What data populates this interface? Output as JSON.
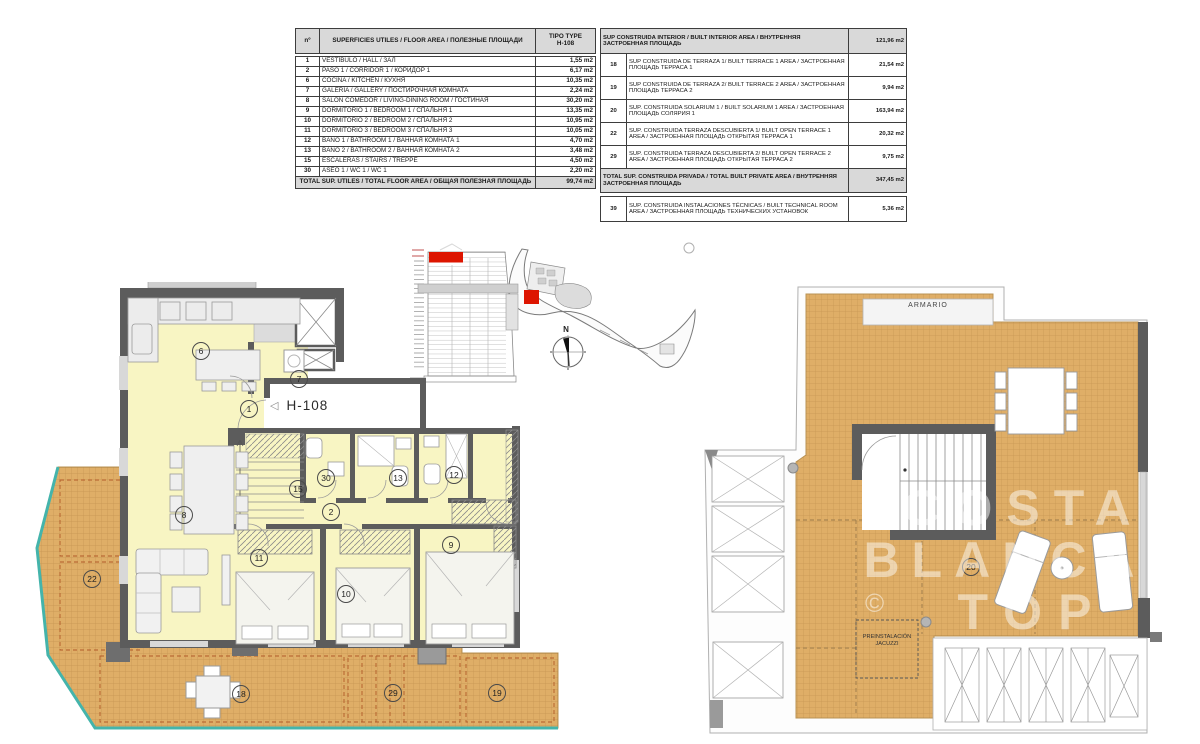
{
  "colors": {
    "terrace_tan": "#dfae67",
    "interior_yellow": "#f8f5c3",
    "wall_gray": "#5c5c5c",
    "teal_edge": "#44b4ab",
    "highlight_red": "#dd1500",
    "table_header_gray": "#d9d9d9"
  },
  "unit": {
    "label": "H-108",
    "pointer": "◁"
  },
  "tables": {
    "floor_area": {
      "col_num": "nº",
      "col_desc": "SUPERFICIES UTILES / FLOOR AREA / ПОЛЕЗНЫЕ ПЛОЩАДИ",
      "col_type_line1": "TIPO TYPE",
      "col_type_line2": "H-108",
      "rows": [
        {
          "num": "1",
          "desc": "VESTÍBULO / HALL / ЗАЛ",
          "area": "1,55 m2"
        },
        {
          "num": "2",
          "desc": "PASO 1 /  CORRIDOR 1 / КОРИДОР 1",
          "area": "6,17 m2"
        },
        {
          "num": "6",
          "desc": "COCINA / KITCHEN / КУХНЯ",
          "area": "10,35 m2"
        },
        {
          "num": "7",
          "desc": "GALERÍA / GALLERY / ПОСТИРОЧНАЯ КОМНАТА",
          "area": "2,24 m2"
        },
        {
          "num": "8",
          "desc": "SALÓN COMEDOR  / LIVING-DINING ROOM / ГОСТИНАЯ",
          "area": "30,20 m2"
        },
        {
          "num": "9",
          "desc": "DORMITORIO 1 / BEDROOM 1 / СПАЛЬНЯ 1",
          "area": "13,35 m2"
        },
        {
          "num": "10",
          "desc": "DORMITORIO 2 / BEDROOM 2 / СПАЛЬНЯ 2",
          "area": "10,95 m2"
        },
        {
          "num": "11",
          "desc": "DORMITORIO 3 / BEDROOM 3 / СПАЛЬНЯ 3",
          "area": "10,05 m2"
        },
        {
          "num": "12",
          "desc": "BAÑO 1 / BATHROOM 1 / ВАННАЯ КОМНАТА 1",
          "area": "4,70 m2"
        },
        {
          "num": "13",
          "desc": "BAÑO 2 / BATHROOM 2 / ВАННАЯ КОМНАТА 2",
          "area": "3,48 m2"
        },
        {
          "num": "15",
          "desc": "ESCALERAS / STAIRS / TREPPE",
          "area": "4,50 m2"
        },
        {
          "num": "30",
          "desc": "ASEO 1 / WC 1 / WC 1",
          "area": "2,20 m2"
        }
      ],
      "total_label": "TOTAL  SUP. UTILES / TOTAL FLOOR AREA / ОБЩАЯ ПОЛЕЗНАЯ ПЛОЩАДЬ",
      "total_value": "99,74 m2"
    },
    "built_area": {
      "header_desc": "SUP CONSTRUIDA INTERIOR / BUILT INTERIOR AREA / ВНУТРЕННЯЯ ЗАСТРОЕННАЯ ПЛОЩАДЬ",
      "header_value": "121,96 m2",
      "rows": [
        {
          "num": "18",
          "desc": "SUP CONSTRUIDA DE TERRAZA 1/ BUILT TERRACE 1 AREA / ЗАСТРОЕННАЯ ПЛОЩАДЬ ТЕРРАСА  1",
          "value": "21,54 m2"
        },
        {
          "num": "19",
          "desc": "SUP CONSTRUIDA DE TERRAZA 2/ BUILT TERRACE 2 AREA / ЗАСТРОЕННАЯ ПЛОЩАДЬ ТЕРРАСА  2",
          "value": "9,94 m2"
        },
        {
          "num": "20",
          "desc": "SUP. CONSTRUIDA SOLARIUM 1 / BUILT SOLARIUM 1 AREA / ЗАСТРОЕННАЯ ПЛОЩАДЬ СОЛЯРИЯ  1",
          "value": "163,94 m2"
        },
        {
          "num": "22",
          "desc": "SUP. CONSTRUIDA TERRAZA DESCUBIERTA 1/ BUILT OPEN TERRACE 1 AREA / ЗАСТРОЕННАЯ ПЛОЩАДЬ ОТКРЫТАЯ ТЕРРАСА  1",
          "value": "20,32 m2"
        },
        {
          "num": "29",
          "desc": "SUP. CONSTRUIDA TERRAZA DESCUBIERTA 2/ BUILT OPEN TERRACE 2 AREA / ЗАСТРОЕННАЯ ПЛОЩАДЬ ОТКРЫТАЯ ТЕРРАСА  2",
          "value": "9,75 m2"
        }
      ],
      "total_label": "TOTAL SUP. CONSTRUIDA PRIVADA / TOTAL  BUILT PRIVATE AREA / ВНУТРЕННЯЯ ЗАСТРОЕННАЯ ПЛОЩАДЬ",
      "total_value": "347,45 m2",
      "technical": {
        "num": "39",
        "desc": "SUP. CONSTRUIDA INSTALACIONES TÉCNICAS / BUILT TECHNICAL ROOM AREA / ЗАСТРОЕННАЯ ПЛОЩАДЬ ТЕХНИЧЕСКИХ УСТАНОВОК",
        "value": "5,36 m2"
      }
    }
  },
  "plans": {
    "left": {
      "labels": [
        {
          "n": "6",
          "x": 200,
          "y": 350
        },
        {
          "n": "7",
          "x": 298,
          "y": 378
        },
        {
          "n": "1",
          "x": 248,
          "y": 408
        },
        {
          "n": "15",
          "x": 297,
          "y": 488
        },
        {
          "n": "30",
          "x": 325,
          "y": 477
        },
        {
          "n": "13",
          "x": 397,
          "y": 477
        },
        {
          "n": "12",
          "x": 453,
          "y": 474
        },
        {
          "n": "2",
          "x": 330,
          "y": 511
        },
        {
          "n": "8",
          "x": 183,
          "y": 514
        },
        {
          "n": "11",
          "x": 258,
          "y": 557
        },
        {
          "n": "10",
          "x": 345,
          "y": 593
        },
        {
          "n": "9",
          "x": 450,
          "y": 544
        },
        {
          "n": "22",
          "x": 91,
          "y": 578
        },
        {
          "n": "18",
          "x": 240,
          "y": 693
        },
        {
          "n": "29",
          "x": 392,
          "y": 692
        },
        {
          "n": "19",
          "x": 496,
          "y": 692
        }
      ]
    },
    "right": {
      "labels": [
        {
          "n": "20",
          "x": 970,
          "y": 566
        }
      ],
      "armario": "ARMARIO",
      "jacuzzi_line1": "PREINSTALACIÓN",
      "jacuzzi_line2": "JACUZZI"
    }
  },
  "compass": {
    "north": "N"
  },
  "watermark": {
    "line1": "COSTA",
    "line2": "BLANCA",
    "line3": "TOP",
    "copyright": "©"
  }
}
